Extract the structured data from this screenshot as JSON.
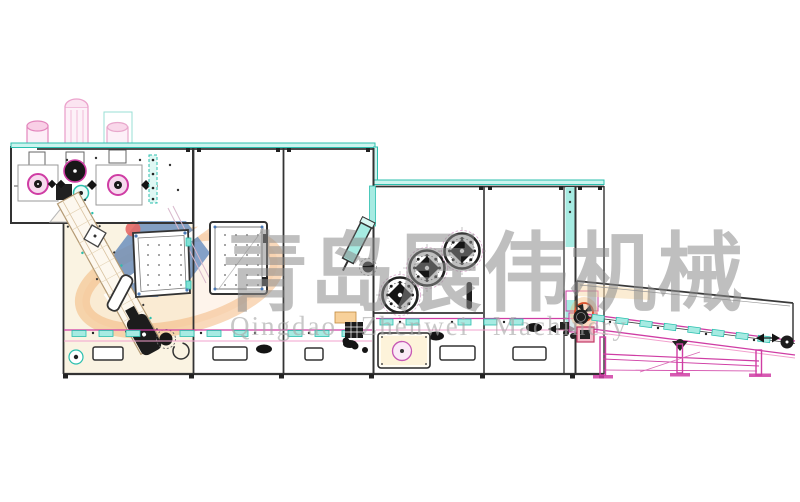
{
  "canvas": {
    "width": 800,
    "height": 502,
    "background": "#ffffff"
  },
  "watermark": {
    "brand_cn": "青岛展伟机械",
    "brand_en": "Qingdao Zhenwei Machinery",
    "text_color_cn": "#8c8c8c",
    "text_color_en": "#a8a8a8",
    "logo_colors": {
      "swoosh_orange": "#f2a75f",
      "hexagon_blue": "#4a78b4",
      "dot_red": "#e25050"
    }
  },
  "drawing_colors": {
    "outline_dark": "#333333",
    "teal_line": "#2bbfae",
    "teal_fill": "#a6ebe2",
    "magenta": "#cf3da4",
    "pink": "#f2a0cd",
    "cream_panel": "#faf3e2",
    "orange_tint": "#f6c178",
    "fan_red": "#d94f2a",
    "logo_blue": "#4a78b4"
  }
}
